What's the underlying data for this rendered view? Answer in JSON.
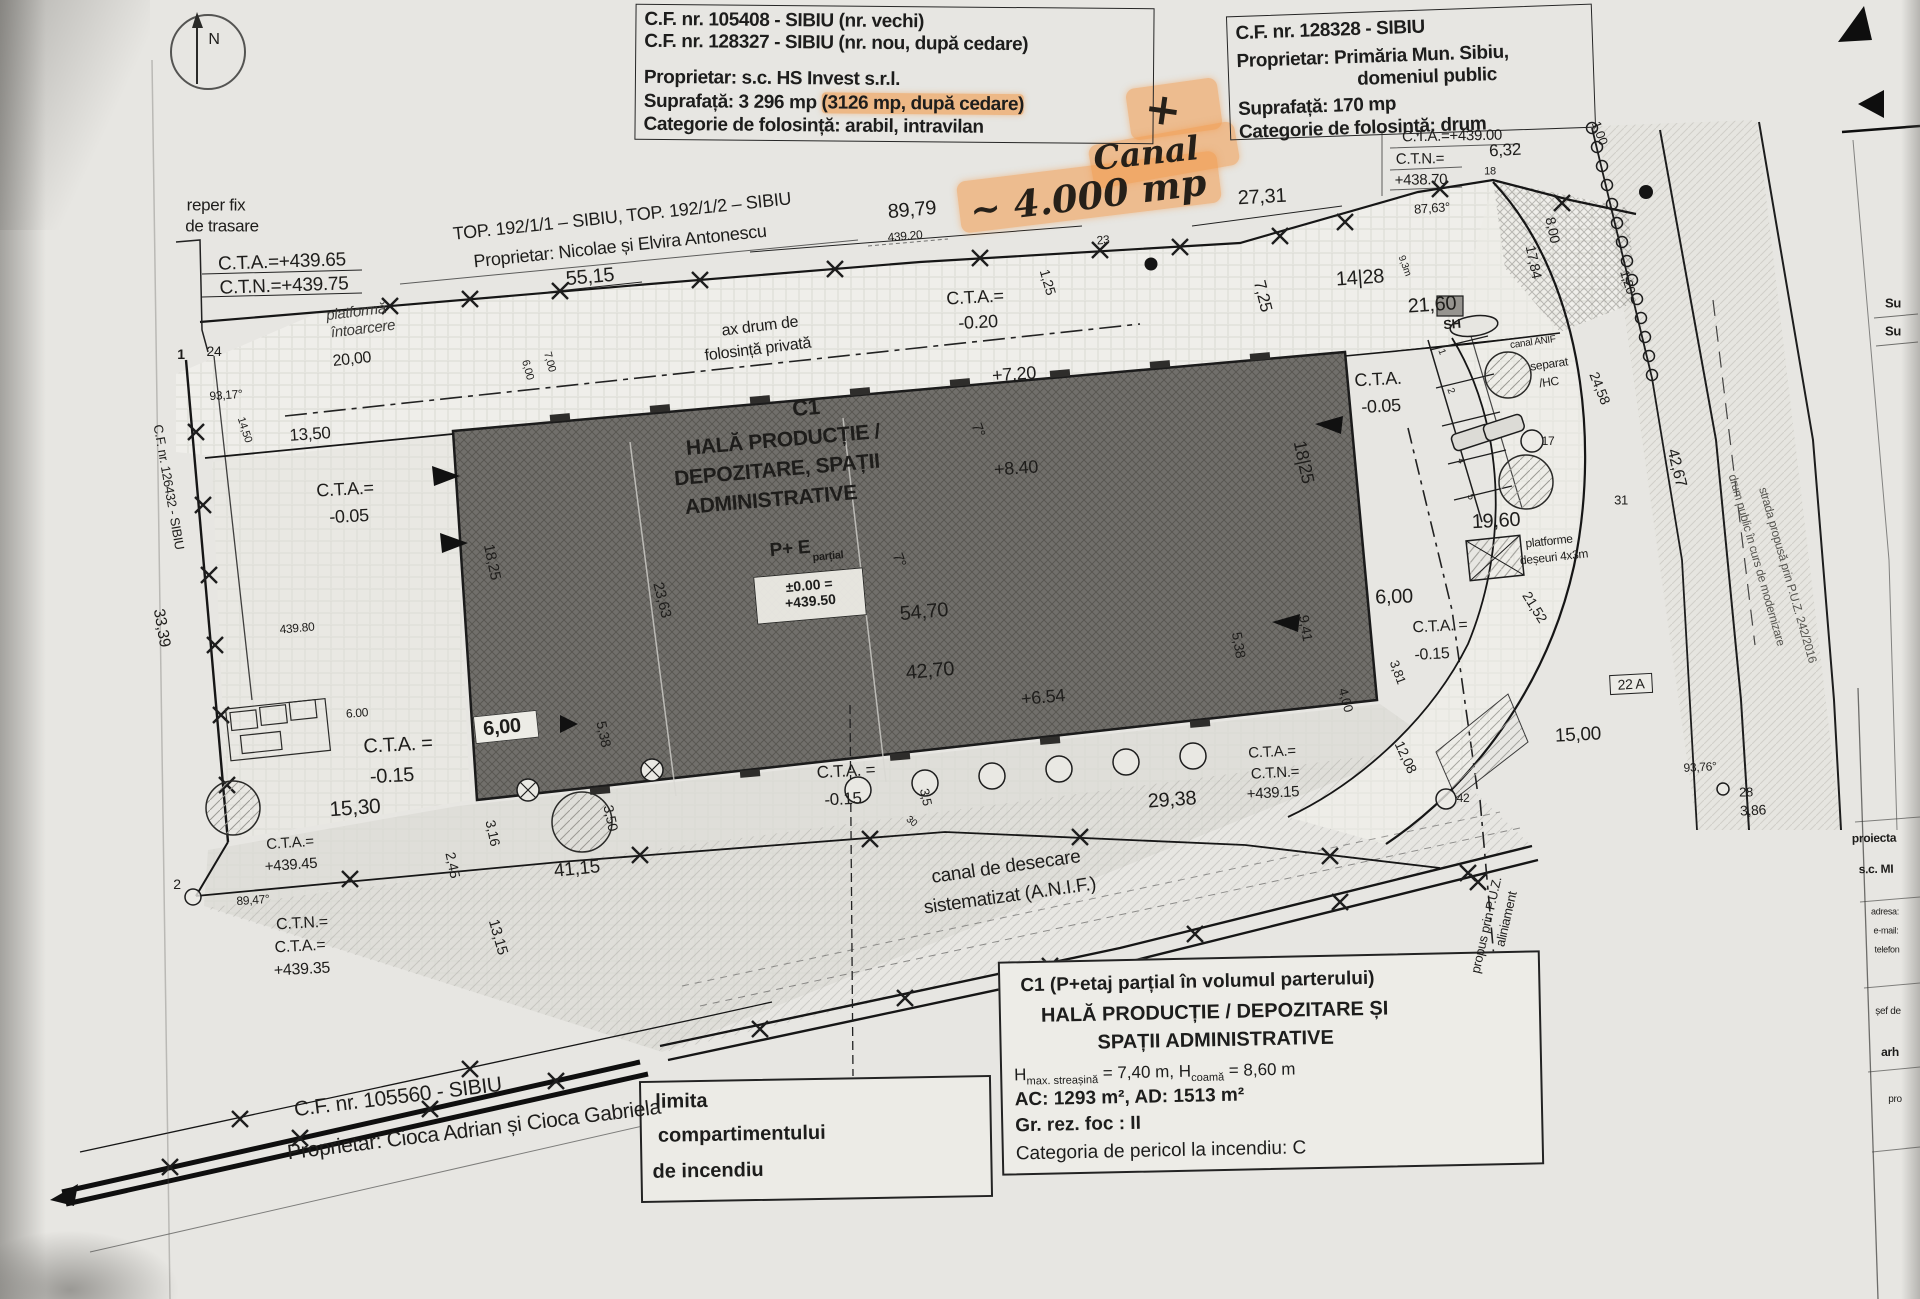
{
  "compass": {
    "label": "N"
  },
  "title_block_1": {
    "line1": "C.F. nr. 105408 - SIBIU (nr. vechi)",
    "line2": "C.F. nr. 128327 - SIBIU (nr. nou, după cedare)",
    "line3": "Proprietar: s.c. HS Invest s.r.l.",
    "line4_pre": "Suprafață: 3 296 mp ",
    "line4_hl": "(3126 mp, după cedare)",
    "line5": "Categorie de folosință: arabil, intravilan"
  },
  "title_block_2": {
    "line1": "C.F. nr. 128328 - SIBIU",
    "line2": "Proprietar:  Primăria Mun. Sibiu,",
    "line3": "domeniul public",
    "line4": "Suprafață: 170 mp",
    "line5": "Categorie de folosință: drum"
  },
  "annotations": {
    "plus": "+",
    "canal_word": "Canal",
    "canal_area": "~ 4.000 mp"
  },
  "building_levels": {
    "zero": "±0.00 =",
    "abs": "+439.50"
  },
  "info_box": {
    "line1": "C1 (P+etaj parțial în volumul parterului)",
    "line2": "HALĂ PRODUCȚIE / DEPOZITARE ȘI",
    "line3": "SPAȚII ADMINISTRATIVE",
    "h1": "H",
    "h1sub": "max. streașină",
    "h2": " = 7,40 m, H",
    "h2sub": "coamă",
    "h3": " = 8,60 m",
    "line5": "AC: 1293 m², AD: 1513 m²",
    "line6": "Gr. rez. foc : II",
    "line7": "Categoria de pericol la incendiu: C"
  },
  "limita_box": {
    "line1": "limita",
    "line2": "compartimentului",
    "line3": "de incendiu"
  },
  "labels": [
    {
      "t": "reper fix",
      "x": 216,
      "y": 205,
      "r": 0,
      "s": 17
    },
    {
      "t": "de trasare",
      "x": 222,
      "y": 226,
      "r": 0,
      "s": 17
    },
    {
      "t": "C.T.A.=+439.65",
      "x": 282,
      "y": 262,
      "r": -2,
      "s": 19
    },
    {
      "t": "C.T.N.=+439.75",
      "x": 284,
      "y": 286,
      "r": -2,
      "s": 19
    },
    {
      "t": "TOP. 192/1/1 – SIBIU, TOP. 192/1/2 – SIBIU",
      "x": 622,
      "y": 216,
      "r": -6,
      "s": 18
    },
    {
      "t": "Proprietar: Nicolae și Elvira Antonescu",
      "x": 620,
      "y": 246,
      "r": -6,
      "s": 18
    },
    {
      "t": "89,79",
      "x": 912,
      "y": 210,
      "r": -5,
      "s": 20
    },
    {
      "t": "439.20",
      "x": 905,
      "y": 236,
      "r": -5,
      "s": 12
    },
    {
      "t": "55,15",
      "x": 590,
      "y": 277,
      "r": -5,
      "s": 20
    },
    {
      "t": "platformă",
      "x": 356,
      "y": 312,
      "r": -7,
      "s": 15,
      "i": 1
    },
    {
      "t": "întoarcere",
      "x": 363,
      "y": 329,
      "r": -7,
      "s": 15,
      "i": 1
    },
    {
      "t": "20,00",
      "x": 352,
      "y": 360,
      "r": -6,
      "s": 16
    },
    {
      "t": "ax drum de",
      "x": 760,
      "y": 327,
      "r": -7,
      "s": 16
    },
    {
      "t": "folosință privată",
      "x": 758,
      "y": 350,
      "r": -7,
      "s": 16
    },
    {
      "t": "C.T.A.=",
      "x": 975,
      "y": 297,
      "r": -3,
      "s": 18
    },
    {
      "t": "-0.20",
      "x": 978,
      "y": 322,
      "r": -3,
      "s": 18
    },
    {
      "t": "+7.20",
      "x": 1014,
      "y": 374,
      "r": -4,
      "s": 18
    },
    {
      "t": "27,31",
      "x": 1262,
      "y": 197,
      "r": -3,
      "s": 20
    },
    {
      "t": "7,25",
      "x": 1263,
      "y": 296,
      "r": 76,
      "s": 17
    },
    {
      "t": "1,25",
      "x": 1048,
      "y": 282,
      "r": 74,
      "s": 14
    },
    {
      "t": "23",
      "x": 1103,
      "y": 240,
      "r": -5,
      "s": 12
    },
    {
      "t": "6,00",
      "x": 527,
      "y": 370,
      "r": 75,
      "s": 11
    },
    {
      "t": "7,00",
      "x": 549,
      "y": 362,
      "r": 75,
      "s": 11
    },
    {
      "t": "C.T.A.=+439.00",
      "x": 1452,
      "y": 136,
      "r": -1,
      "s": 15
    },
    {
      "t": "C.T.N.=",
      "x": 1420,
      "y": 159,
      "r": -1,
      "s": 15
    },
    {
      "t": "+438.70",
      "x": 1421,
      "y": 180,
      "r": -1,
      "s": 15
    },
    {
      "t": "6,32",
      "x": 1505,
      "y": 150,
      "r": -3,
      "s": 17
    },
    {
      "t": "1,00",
      "x": 1600,
      "y": 133,
      "r": 70,
      "s": 13
    },
    {
      "t": "18",
      "x": 1490,
      "y": 172,
      "r": 0,
      "s": 11
    },
    {
      "t": "87,63°",
      "x": 1432,
      "y": 208,
      "r": -4,
      "s": 13
    },
    {
      "t": "14|28",
      "x": 1360,
      "y": 278,
      "r": -4,
      "s": 20
    },
    {
      "t": "9,3m",
      "x": 1404,
      "y": 266,
      "r": 70,
      "s": 10
    },
    {
      "t": "21,60",
      "x": 1432,
      "y": 305,
      "r": -4,
      "s": 20
    },
    {
      "t": "8,00",
      "x": 1553,
      "y": 230,
      "r": 78,
      "s": 14
    },
    {
      "t": "17,84",
      "x": 1534,
      "y": 262,
      "r": 78,
      "s": 14
    },
    {
      "t": "1,20",
      "x": 1628,
      "y": 282,
      "r": 72,
      "s": 13
    },
    {
      "t": "24,58",
      "x": 1600,
      "y": 388,
      "r": 68,
      "s": 14
    },
    {
      "t": "SH",
      "x": 1452,
      "y": 324,
      "r": -5,
      "s": 13,
      "b": 1
    },
    {
      "t": "canal ANIF",
      "x": 1533,
      "y": 343,
      "r": -8,
      "s": 10
    },
    {
      "t": "separat",
      "x": 1549,
      "y": 364,
      "r": -8,
      "s": 12
    },
    {
      "t": "/HC",
      "x": 1549,
      "y": 382,
      "r": -8,
      "s": 12
    },
    {
      "t": "17",
      "x": 1548,
      "y": 441,
      "r": 0,
      "s": 12
    },
    {
      "t": "C.T.A.",
      "x": 1378,
      "y": 379,
      "r": -3,
      "s": 18
    },
    {
      "t": "-0.05",
      "x": 1381,
      "y": 406,
      "r": -3,
      "s": 18
    },
    {
      "t": "18|25",
      "x": 1304,
      "y": 462,
      "r": 78,
      "s": 18
    },
    {
      "t": "19,60",
      "x": 1496,
      "y": 521,
      "r": -3,
      "s": 20
    },
    {
      "t": "platforme",
      "x": 1549,
      "y": 541,
      "r": -6,
      "s": 12
    },
    {
      "t": "deșeuri 4x3m",
      "x": 1554,
      "y": 557,
      "r": -6,
      "s": 12
    },
    {
      "t": "21,52",
      "x": 1535,
      "y": 607,
      "r": 58,
      "s": 14
    },
    {
      "t": "6,00",
      "x": 1394,
      "y": 597,
      "r": -2,
      "s": 20
    },
    {
      "t": "C.T.A. =",
      "x": 1440,
      "y": 627,
      "r": -3,
      "s": 16
    },
    {
      "t": "-0.15",
      "x": 1432,
      "y": 655,
      "r": -3,
      "s": 16
    },
    {
      "t": "3,81",
      "x": 1398,
      "y": 672,
      "r": 70,
      "s": 13
    },
    {
      "t": "9,41",
      "x": 1306,
      "y": 628,
      "r": 80,
      "s": 14
    },
    {
      "t": "5,38",
      "x": 1239,
      "y": 645,
      "r": 80,
      "s": 14
    },
    {
      "t": "4,00",
      "x": 1346,
      "y": 700,
      "r": 75,
      "s": 13
    },
    {
      "t": "12,08",
      "x": 1406,
      "y": 757,
      "r": 65,
      "s": 14
    },
    {
      "t": "42",
      "x": 1463,
      "y": 798,
      "r": 0,
      "s": 12
    },
    {
      "t": "15,00",
      "x": 1578,
      "y": 735,
      "r": -3,
      "s": 19
    },
    {
      "t": "93,76°",
      "x": 1700,
      "y": 767,
      "r": -3,
      "s": 12
    },
    {
      "t": "28",
      "x": 1746,
      "y": 792,
      "r": 0,
      "s": 13
    },
    {
      "t": "3,86",
      "x": 1753,
      "y": 810,
      "r": -3,
      "s": 14
    },
    {
      "t": "22 A",
      "x": 1631,
      "y": 684,
      "r": -3,
      "s": 14,
      "cls": "boxed"
    },
    {
      "t": "42,67",
      "x": 1676,
      "y": 468,
      "r": 76,
      "s": 16
    },
    {
      "t": "31",
      "x": 1621,
      "y": 500,
      "r": 0,
      "s": 13
    },
    {
      "t": "drum public în curs de modernizare",
      "x": 1757,
      "y": 560,
      "r": 74,
      "s": 12,
      "cls": "faint"
    },
    {
      "t": "strada propusă prin P.U.Z. 242/2016",
      "x": 1788,
      "y": 575,
      "r": 74,
      "s": 12,
      "cls": "faint"
    },
    {
      "t": "Su",
      "x": 1893,
      "y": 303,
      "r": 0,
      "s": 13,
      "b": 1
    },
    {
      "t": "Su",
      "x": 1893,
      "y": 331,
      "r": 0,
      "s": 13,
      "b": 1
    },
    {
      "t": "proiecta",
      "x": 1874,
      "y": 838,
      "r": -1,
      "s": 12,
      "b": 1
    },
    {
      "t": "s.c. MI",
      "x": 1876,
      "y": 869,
      "r": -1,
      "s": 12,
      "b": 1
    },
    {
      "t": "adresa:",
      "x": 1885,
      "y": 912,
      "r": 0,
      "s": 9
    },
    {
      "t": "e-mail:",
      "x": 1886,
      "y": 931,
      "r": 0,
      "s": 9
    },
    {
      "t": "telefon",
      "x": 1887,
      "y": 950,
      "r": 0,
      "s": 9
    },
    {
      "t": "șef de",
      "x": 1888,
      "y": 1012,
      "r": 0,
      "s": 10
    },
    {
      "t": "arh",
      "x": 1890,
      "y": 1052,
      "r": 0,
      "s": 12,
      "b": 1
    },
    {
      "t": "pro",
      "x": 1895,
      "y": 1100,
      "r": 0,
      "s": 10
    },
    {
      "t": "C1",
      "x": 806,
      "y": 408,
      "r": -5,
      "s": 22,
      "b": 1
    },
    {
      "t": "HALĂ PRODUCȚIE /",
      "x": 783,
      "y": 440,
      "r": -5,
      "s": 21,
      "b": 1
    },
    {
      "t": "DEPOZITARE, SPAȚII",
      "x": 777,
      "y": 470,
      "r": -5,
      "s": 21,
      "b": 1
    },
    {
      "t": "ADMINISTRATIVE",
      "x": 771,
      "y": 500,
      "r": -5,
      "s": 21,
      "b": 1
    },
    {
      "t": "P+ E",
      "x": 790,
      "y": 549,
      "r": -5,
      "s": 19,
      "b": 1
    },
    {
      "t": "parțial",
      "x": 828,
      "y": 557,
      "r": -5,
      "s": 11,
      "b": 1
    },
    {
      "t": "54,70",
      "x": 924,
      "y": 612,
      "r": -5,
      "s": 20
    },
    {
      "t": "42,70",
      "x": 930,
      "y": 671,
      "r": -5,
      "s": 20
    },
    {
      "t": "23,63",
      "x": 662,
      "y": 600,
      "r": 76,
      "s": 15
    },
    {
      "t": "18,25",
      "x": 492,
      "y": 562,
      "r": 78,
      "s": 15
    },
    {
      "t": "+8.40",
      "x": 1016,
      "y": 468,
      "r": -4,
      "s": 18
    },
    {
      "t": "7°",
      "x": 978,
      "y": 430,
      "r": 70,
      "s": 15
    },
    {
      "t": "7°",
      "x": 899,
      "y": 560,
      "r": 70,
      "s": 15
    },
    {
      "t": "+6.54",
      "x": 1043,
      "y": 697,
      "r": -5,
      "s": 18
    },
    {
      "t": "6,00",
      "x": 506,
      "y": 727,
      "r": -6,
      "s": 20,
      "cls": "chip"
    },
    {
      "t": "5,38",
      "x": 604,
      "y": 734,
      "r": 78,
      "s": 14
    },
    {
      "t": "3,50",
      "x": 611,
      "y": 818,
      "r": 78,
      "s": 14
    },
    {
      "t": "3,16",
      "x": 493,
      "y": 833,
      "r": 78,
      "s": 14
    },
    {
      "t": "2,45",
      "x": 453,
      "y": 865,
      "r": 78,
      "s": 14
    },
    {
      "t": "13,15",
      "x": 498,
      "y": 937,
      "r": 74,
      "s": 15
    },
    {
      "t": "41,15",
      "x": 577,
      "y": 869,
      "r": -6,
      "s": 19
    },
    {
      "t": "33,39",
      "x": 161,
      "y": 628,
      "r": 80,
      "s": 16
    },
    {
      "t": "C.F. nr. 126432 - SIBIU",
      "x": 169,
      "y": 487,
      "r": 80,
      "s": 13
    },
    {
      "t": "93,17°",
      "x": 226,
      "y": 395,
      "r": -4,
      "s": 12
    },
    {
      "t": "1",
      "x": 181,
      "y": 354,
      "r": 0,
      "s": 14,
      "b": 1
    },
    {
      "t": "24",
      "x": 214,
      "y": 351,
      "r": 0,
      "s": 14
    },
    {
      "t": "14,50",
      "x": 244,
      "y": 430,
      "r": 72,
      "s": 11
    },
    {
      "t": "13,50",
      "x": 310,
      "y": 434,
      "r": -4,
      "s": 17
    },
    {
      "t": "C.T.A.=",
      "x": 345,
      "y": 489,
      "r": -3,
      "s": 18
    },
    {
      "t": "-0.05",
      "x": 349,
      "y": 516,
      "r": -3,
      "s": 18
    },
    {
      "t": "439.80",
      "x": 297,
      "y": 628,
      "r": -5,
      "s": 12
    },
    {
      "t": "6.00",
      "x": 357,
      "y": 713,
      "r": -4,
      "s": 12
    },
    {
      "t": "C.T.A. =",
      "x": 398,
      "y": 745,
      "r": -3,
      "s": 20
    },
    {
      "t": "-0.15",
      "x": 392,
      "y": 776,
      "r": -3,
      "s": 20
    },
    {
      "t": "15,30",
      "x": 355,
      "y": 808,
      "r": -4,
      "s": 21
    },
    {
      "t": "C.T.A.=",
      "x": 290,
      "y": 843,
      "r": -4,
      "s": 15
    },
    {
      "t": "+439.45",
      "x": 291,
      "y": 865,
      "r": -4,
      "s": 15
    },
    {
      "t": "89,47°",
      "x": 253,
      "y": 900,
      "r": -4,
      "s": 12
    },
    {
      "t": "2",
      "x": 177,
      "y": 884,
      "r": 0,
      "s": 14
    },
    {
      "t": "C.T.N.=",
      "x": 302,
      "y": 924,
      "r": -3,
      "s": 16
    },
    {
      "t": "C.T.A.=",
      "x": 300,
      "y": 947,
      "r": -3,
      "s": 16
    },
    {
      "t": "+439.35",
      "x": 302,
      "y": 970,
      "r": -3,
      "s": 16
    },
    {
      "t": "C.F. nr. 105560 - SIBIU",
      "x": 398,
      "y": 1097,
      "r": -7,
      "s": 21
    },
    {
      "t": "Proprietar: Cioca Adrian și Cioca Gabriela",
      "x": 474,
      "y": 1130,
      "r": -7,
      "s": 21
    },
    {
      "t": "C.T.A. =",
      "x": 846,
      "y": 771,
      "r": -3,
      "s": 17
    },
    {
      "t": "-0.15",
      "x": 843,
      "y": 799,
      "r": -3,
      "s": 17
    },
    {
      "t": "3,5",
      "x": 926,
      "y": 797,
      "r": 78,
      "s": 13
    },
    {
      "t": "30",
      "x": 911,
      "y": 822,
      "r": 40,
      "s": 10
    },
    {
      "t": "29,38",
      "x": 1172,
      "y": 800,
      "r": -4,
      "s": 20
    },
    {
      "t": "C.T.A.=",
      "x": 1272,
      "y": 752,
      "r": -3,
      "s": 15
    },
    {
      "t": "C.T.N.=",
      "x": 1275,
      "y": 773,
      "r": -3,
      "s": 15
    },
    {
      "t": "+439.15",
      "x": 1273,
      "y": 793,
      "r": -3,
      "s": 15
    },
    {
      "t": "canal de desecare",
      "x": 1006,
      "y": 867,
      "r": -8,
      "s": 19
    },
    {
      "t": "sistematizat (A.N.I.F.)",
      "x": 1010,
      "y": 896,
      "r": -8,
      "s": 19
    },
    {
      "t": "aliniament",
      "x": 1506,
      "y": 919,
      "r": -77,
      "s": 13
    },
    {
      "t": "propus prin P.U.Z.",
      "x": 1486,
      "y": 925,
      "r": -77,
      "s": 13
    },
    {
      "t": "1",
      "x": 1441,
      "y": 352,
      "r": 70,
      "s": 10
    },
    {
      "t": "2",
      "x": 1450,
      "y": 391,
      "r": 70,
      "s": 10
    },
    {
      "t": "4",
      "x": 1460,
      "y": 461,
      "r": 70,
      "s": 10
    },
    {
      "t": "5",
      "x": 1470,
      "y": 497,
      "r": 70,
      "s": 10
    }
  ]
}
